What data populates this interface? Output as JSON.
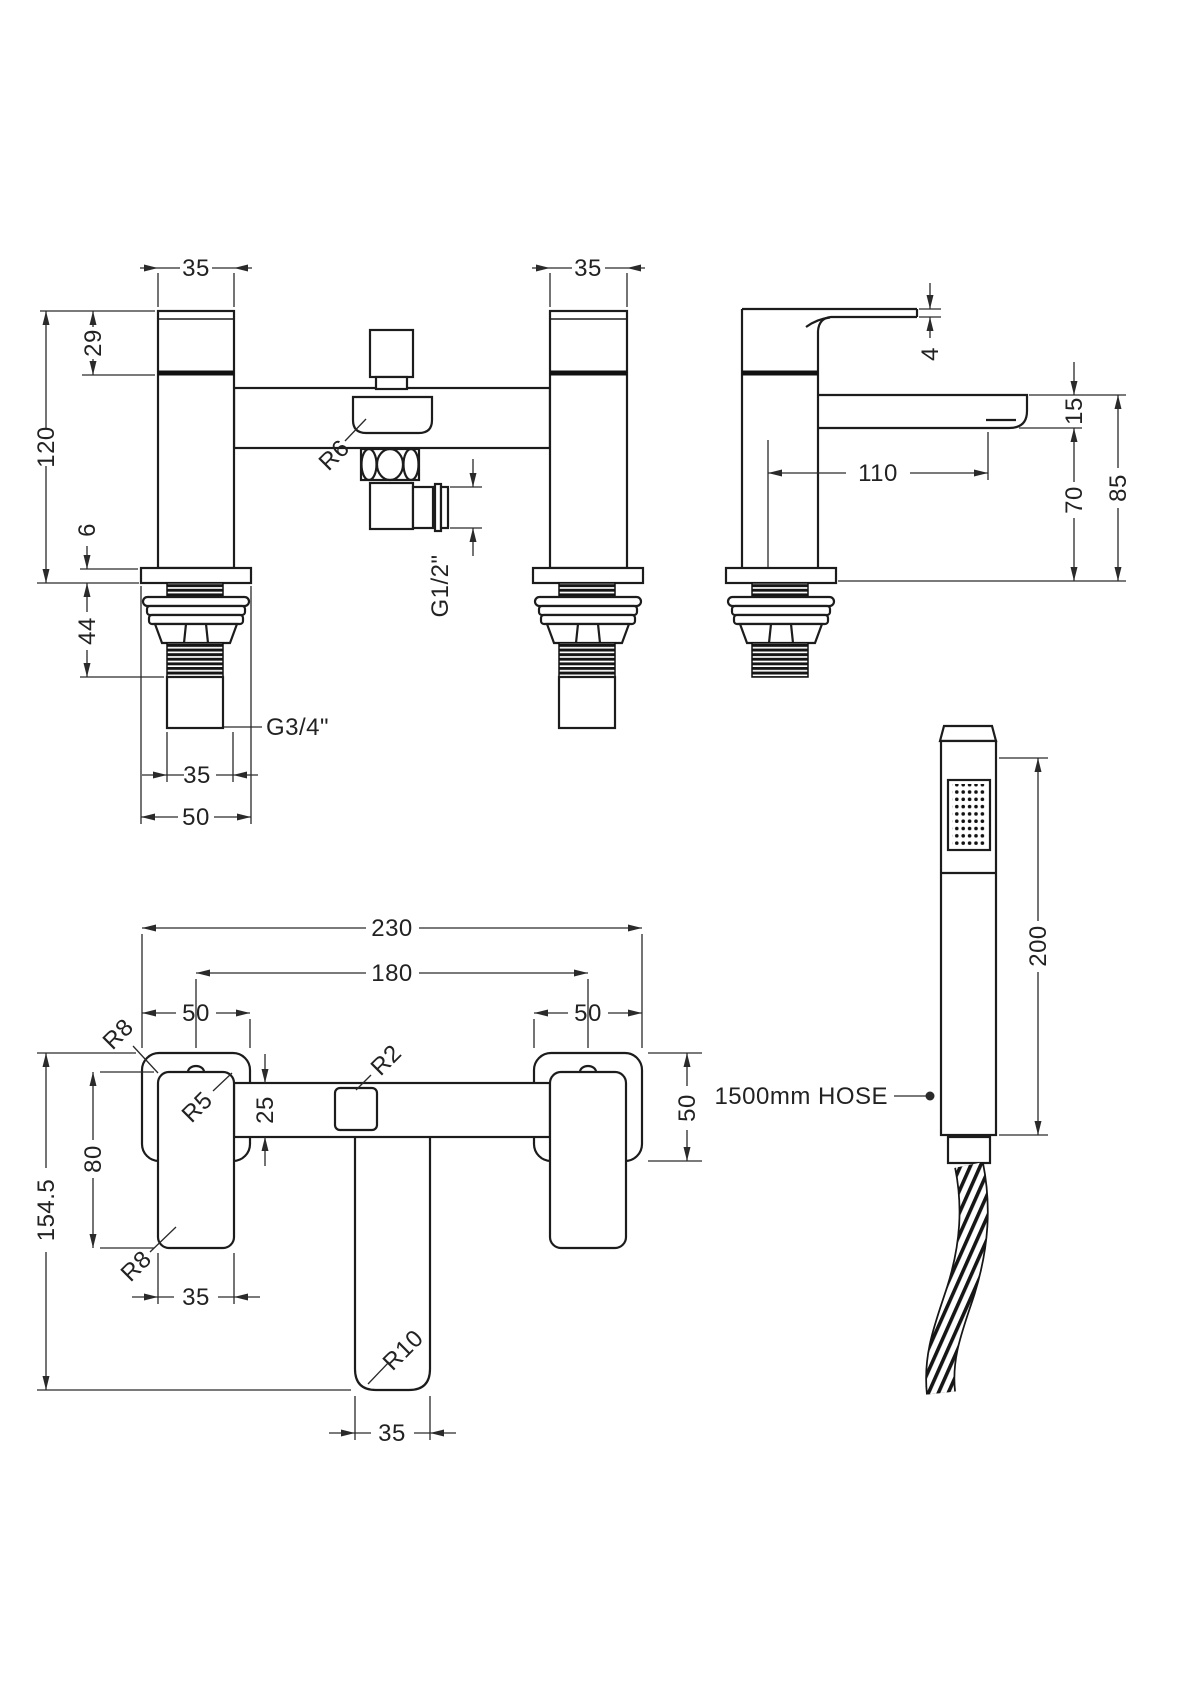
{
  "views": {
    "front": {
      "dim_pillar_width_left": "35",
      "dim_pillar_width_right": "35",
      "dim_handle_height": "29",
      "dim_total_height": "120",
      "dim_base_thickness": "6",
      "dim_shank_length": "44",
      "label_inlet_thread": "G3/4\"",
      "dim_tail_width": "35",
      "dim_flange_width": "50",
      "label_body_radius": "R6",
      "label_outlet_thread": "G1/2\""
    },
    "side": {
      "dim_handle_thickness": "4",
      "dim_spout_depth": "15",
      "dim_spout_reach": "110",
      "dim_spout_clearance": "70",
      "dim_overall_height": "85"
    },
    "top": {
      "dim_overall_width": "230",
      "dim_centres": "180",
      "dim_base_width_left": "50",
      "dim_base_width_right": "50",
      "dim_base_depth": "50",
      "dim_bar_depth": "25",
      "dim_handle_length": "80",
      "dim_overall_depth": "154.5",
      "dim_handle_width": "35",
      "dim_spout_width": "35",
      "label_radius_base_top": "R8",
      "label_radius_handle": "R5",
      "label_radius_base_bottom": "R8",
      "label_radius_diverter": "R2",
      "label_radius_spout": "R10"
    },
    "handset": {
      "dim_length": "200",
      "label_hose": "1500mm HOSE"
    }
  }
}
